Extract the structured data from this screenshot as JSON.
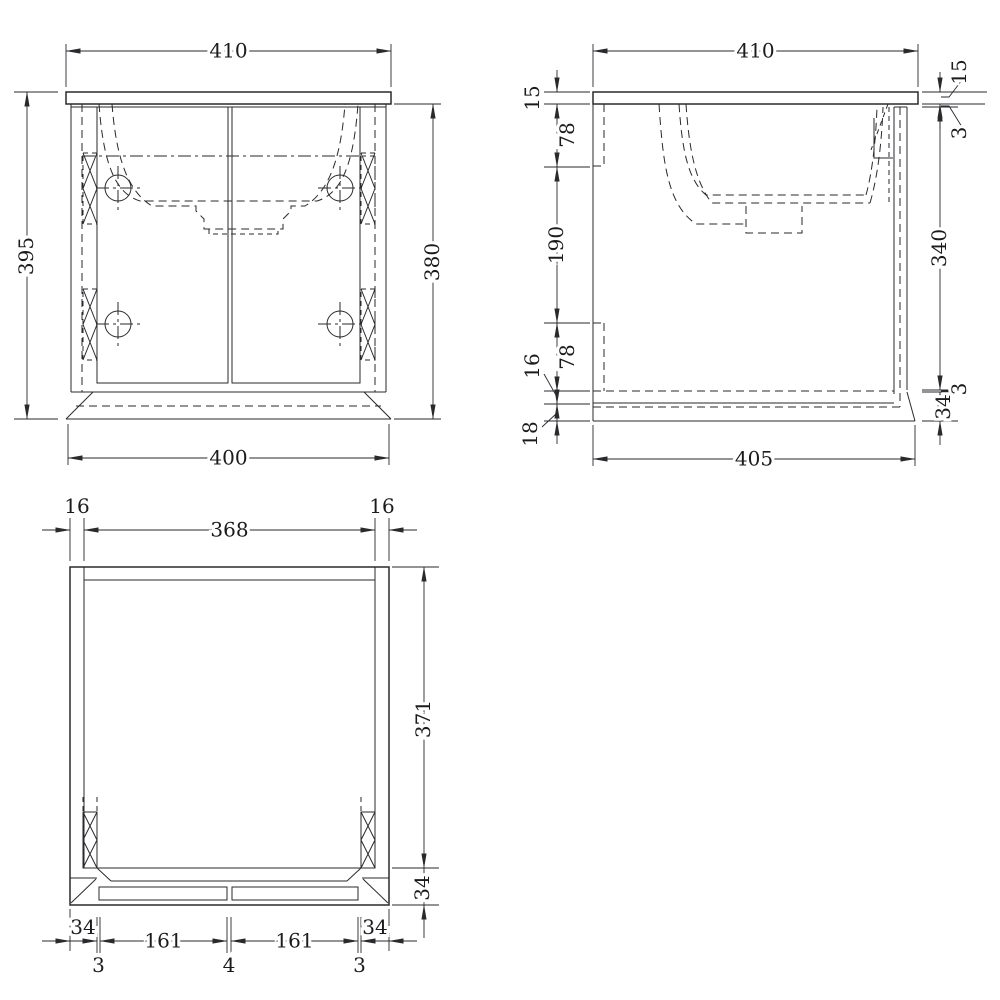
{
  "views": {
    "front": {
      "top": "410",
      "left": "395",
      "right": "380",
      "bottom": "400"
    },
    "side": {
      "top": "410",
      "left": [
        "15",
        "78",
        "190",
        "78",
        "16",
        "18"
      ],
      "right": [
        "15",
        "3",
        "340",
        "3",
        "34"
      ],
      "bottom": "405"
    },
    "bottom": {
      "top": [
        "16",
        "368",
        "16"
      ],
      "right": [
        "371",
        "34"
      ],
      "chain_upper": [
        "34",
        "161",
        "161",
        "34"
      ],
      "chain_lower": [
        "3",
        "4",
        "3"
      ]
    }
  }
}
